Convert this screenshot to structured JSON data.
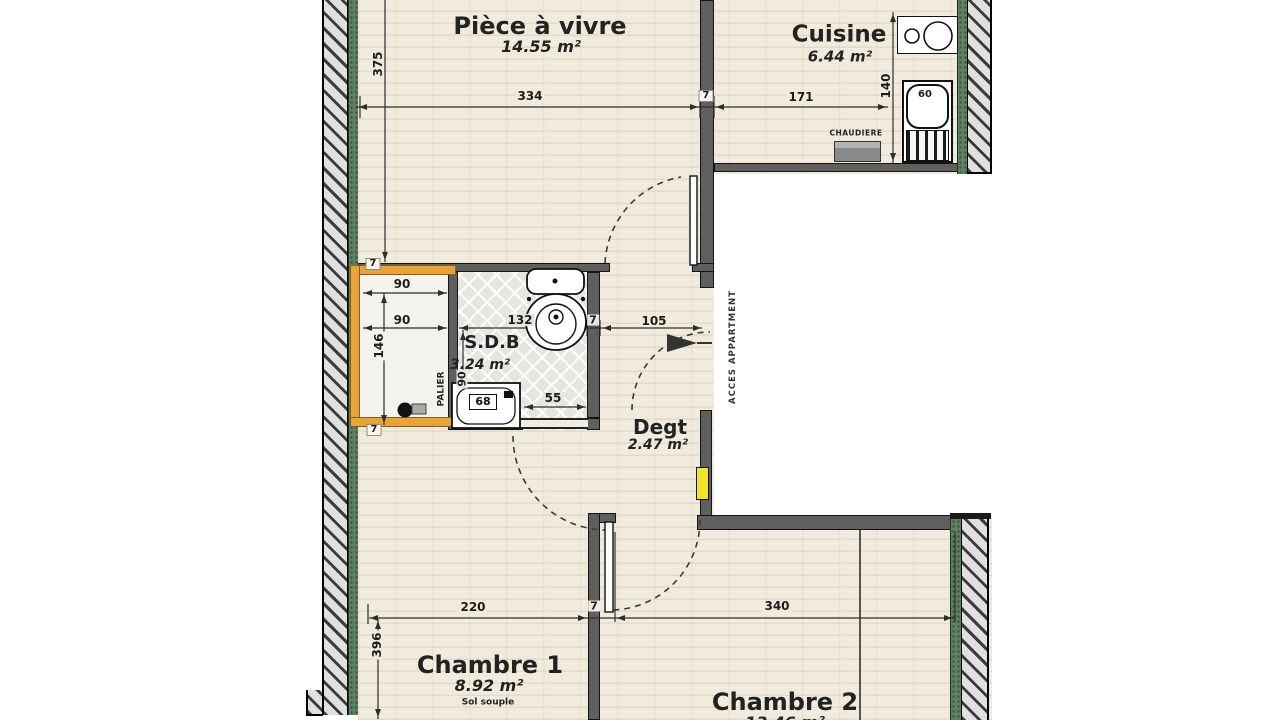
{
  "rooms": [
    {
      "name": "Pièce à vivre",
      "area": "14.55 m²"
    },
    {
      "name": "Cuisine",
      "area": "6.44 m²"
    },
    {
      "name": "S.D.B",
      "area": "3.24 m²"
    },
    {
      "name": "Degt",
      "area": "2.47 m²"
    },
    {
      "name": "Chambre 1",
      "area": "8.92 m²",
      "note": "Sol souple"
    },
    {
      "name": "Chambre 2",
      "area": "13.46 m²"
    }
  ],
  "annotations": {
    "palier": "PALIER",
    "acces": "ACCES APPARTMENT",
    "chaudiere": "CHAUDIERE"
  },
  "dimensions": {
    "d334": "334",
    "d7_top": "7",
    "d171": "171",
    "d140": "140",
    "d375": "375",
    "d7_palier_top": "7",
    "d90_a": "90",
    "d90_b": "90",
    "d146": "146",
    "d7_palier_bottom": "7",
    "d132": "132",
    "d7_sdb": "7",
    "d105": "105",
    "d90_sdb": "90",
    "d55": "55",
    "d68": "68",
    "d60": "60",
    "d220": "220",
    "d7_bottom": "7",
    "d340": "340",
    "d396": "396"
  },
  "colors": {
    "floor": "#f0ebdd",
    "tile": "#e7e5df",
    "wall_interior": "#5f5f5f",
    "wall_hatch_bg": "#e0e0e0",
    "insulation_green": "#5e8060",
    "palier_wall_orange": "#e8a43c",
    "panel_yellow": "#f2e32b",
    "dim_line": "#2d2d2d"
  }
}
